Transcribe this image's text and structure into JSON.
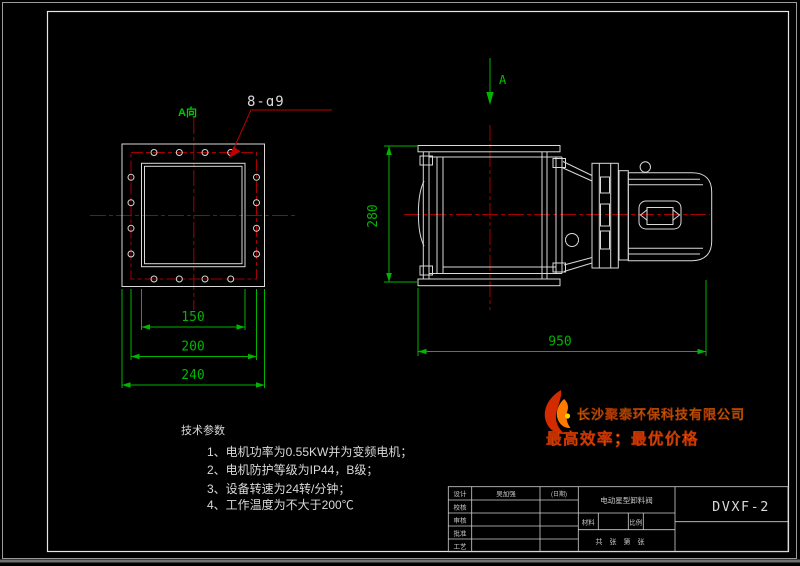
{
  "colors": {
    "background": "#000000",
    "drawing_lines": "#d9d9d9",
    "centerline_red": "#a50000",
    "dimension_green": "#00b400",
    "brand_yellow": "#ffd800",
    "slogan_orange": "#ffa200",
    "flame_red": "#d42a00"
  },
  "annotations": {
    "view_label": "A向",
    "section_label": "A",
    "hole_callout": "8-ɑ9"
  },
  "dimensions": {
    "d150": "150",
    "d200": "200",
    "d240": "240",
    "d280": "280",
    "d950": "950"
  },
  "tech_notes": {
    "heading": "技术参数",
    "items": [
      "1、电机功率为0.55KW并为变频电机；",
      "2、电机防护等级为IP44，B级；",
      "3、设备转速为24转/分钟；",
      "4、工作温度为不大于200℃"
    ]
  },
  "branding": {
    "company": "长沙聚泰环保科技有限公司",
    "slogan": "最高效率；最优价格"
  },
  "title_block": {
    "row_labels": [
      "设计",
      "校核",
      "审核",
      "批准",
      "工艺"
    ],
    "designer": "吴加强",
    "date_label": "(日期)",
    "part_name": "电动星型卸料阀",
    "material_label": "材料",
    "scale_label": "比例",
    "sheet_label": "共　张　第　张",
    "model": "DVXF-2"
  }
}
